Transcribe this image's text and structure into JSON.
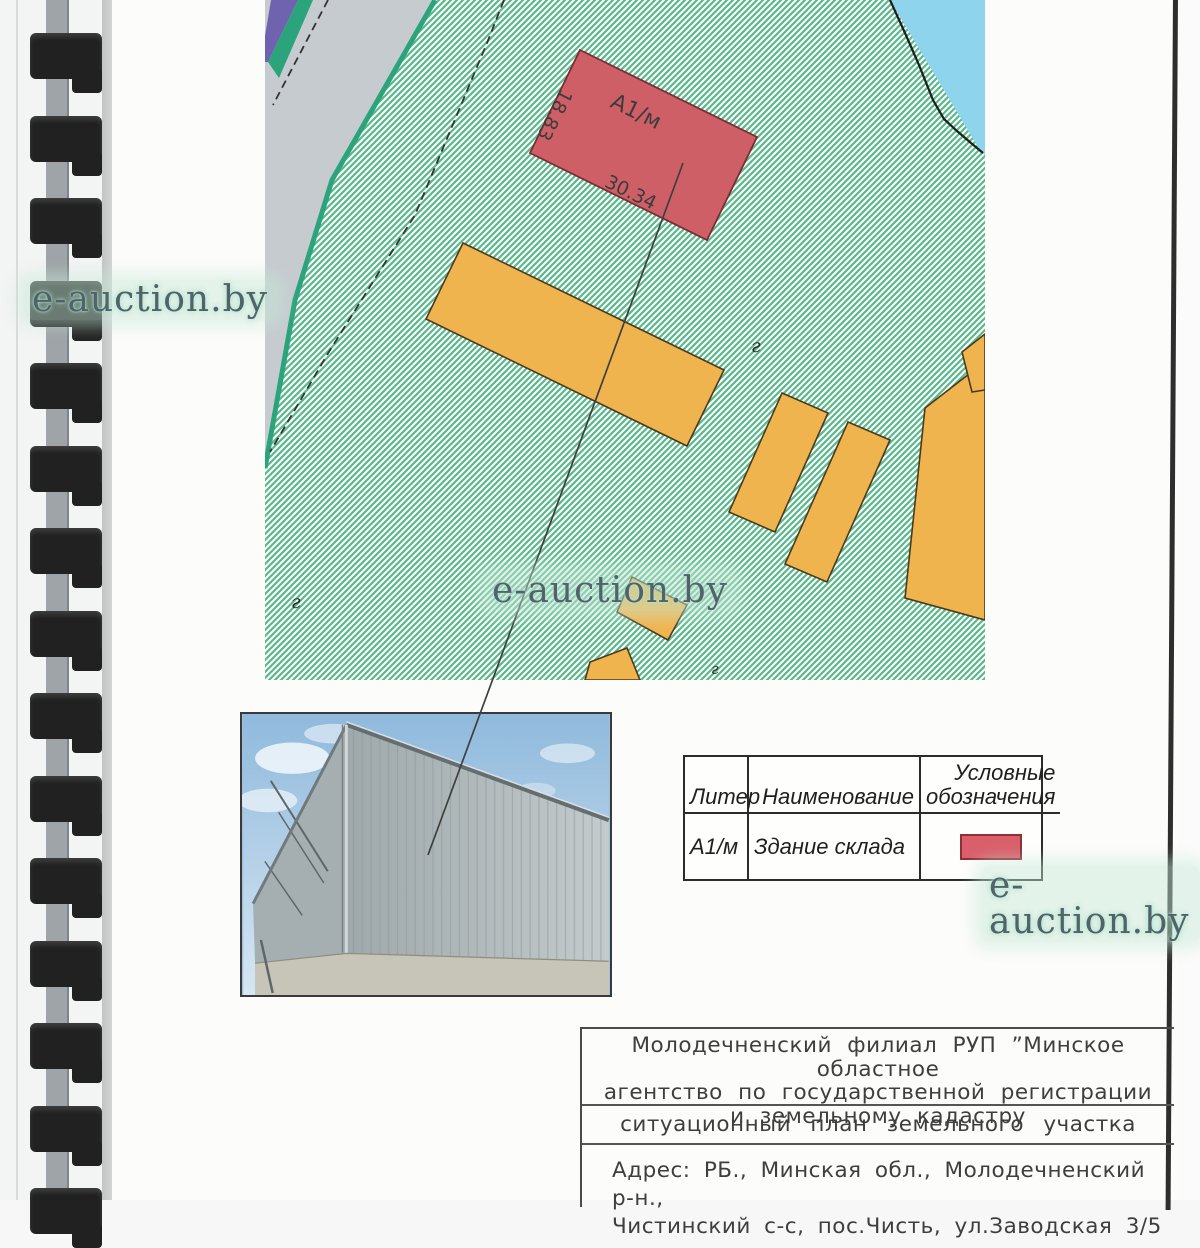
{
  "watermark": {
    "text": "e-auction.by"
  },
  "map": {
    "building_label": "А1/м",
    "dim_side": "18.83",
    "dim_front": "30.34",
    "terrain_marker": "г"
  },
  "legend": {
    "header_liter": "Литер",
    "header_name": "Наименование",
    "header_symbol_line1": "Условные",
    "header_symbol_line2": "обозначения",
    "rows": [
      {
        "liter": "А1/м",
        "name": "Здание склада",
        "symbol_color": "#d9606a"
      }
    ]
  },
  "title_block": {
    "agency_line1": "Молодечненский филиал РУП ”Минское областное",
    "agency_line2": "агентство по государственной регистрации",
    "agency_line3": "и земельному кадастру",
    "doc_type": "ситуационный план земельного участка",
    "address_line1": "Адрес: РБ., Минская обл., Молодечненский р-н.,",
    "address_line2": "Чистинский с-с, пос.Чисть, ул.Заводская 3/5"
  },
  "colors": {
    "plot_hatch_green": "#5eb68e",
    "main_building_red": "#cf5f67",
    "other_buildings_orange": "#f0b44e",
    "water_blue": "#8ed4ec",
    "road_gray": "#c6cbd0",
    "boundary_teal": "#2ba47c",
    "boundary_purple": "#6f63b0"
  }
}
